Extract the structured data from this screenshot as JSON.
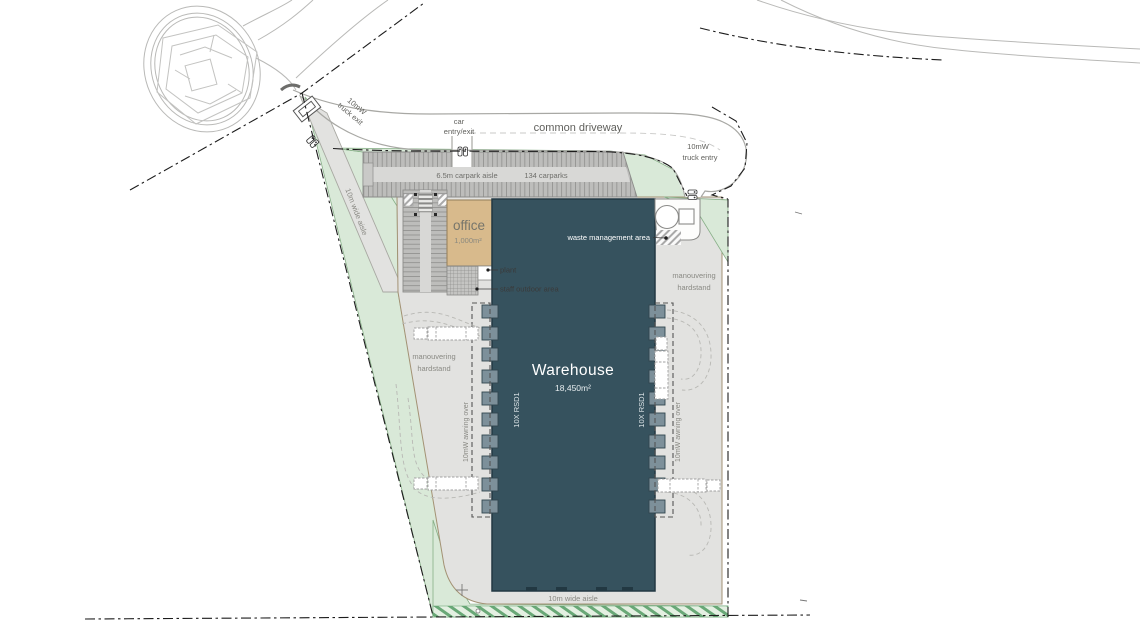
{
  "plan": {
    "driveway": {
      "name": "common driveway",
      "car_entry_1": "car",
      "car_entry_2": "entry/exit",
      "truck_entry_1": "10mW",
      "truck_entry_2": "truck entry",
      "truck_exit_1": "10mW",
      "truck_exit_2": "truck exit"
    },
    "carpark": {
      "aisle": "6.5m carpark aisle",
      "count": "134 carparks"
    },
    "office": {
      "name": "office",
      "area": "1,000m²"
    },
    "warehouse": {
      "name": "Warehouse",
      "area": "18,450m²",
      "rsd_left": "10X RSD1",
      "rsd_right": "10X RSD1"
    },
    "waste": {
      "label": "waste management area"
    },
    "plant": {
      "label": "plant"
    },
    "staff": {
      "label": "staff outdoor area"
    },
    "manouvering_left": {
      "line1": "manouvering",
      "line2": "hardstand"
    },
    "manouvering_right": {
      "line1": "manouvering",
      "line2": "hardstand"
    },
    "awning_left": {
      "label": "10mW awning over"
    },
    "awning_right": {
      "label": "10mW awning over"
    },
    "aisle_left": {
      "label": "10m wide aisle"
    },
    "aisle_bottom": {
      "label": "10m wide aisle"
    }
  },
  "colors": {
    "warehouse": "#36525e",
    "office": "#d8ba8c",
    "landscape": "#d9e9d8",
    "hardstand": "#e2e2e0",
    "carpark": "#bdbdbb",
    "dock": "#7d909a"
  }
}
